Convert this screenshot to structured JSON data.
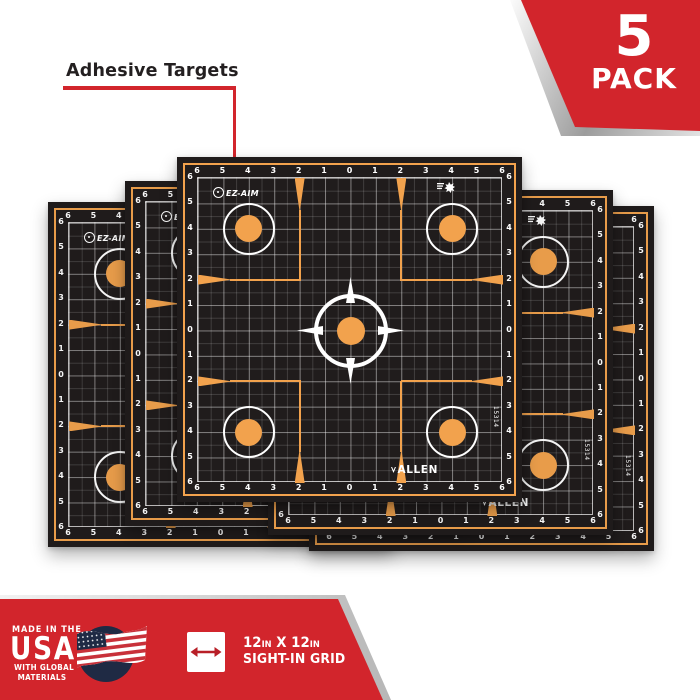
{
  "callout": {
    "label": "Adhesive Targets",
    "line_color": "#D2252C"
  },
  "pack_badge": {
    "count": "5",
    "word": "PACK",
    "red": "#D2252C"
  },
  "target": {
    "scale_numbers": [
      "6",
      "5",
      "4",
      "3",
      "2",
      "1",
      "0",
      "1",
      "2",
      "3",
      "4",
      "5",
      "6"
    ],
    "logo_text": "EZ-AIM",
    "brand_text": "ALLEN",
    "item_number": "15314",
    "sheet_count": 5,
    "colors": {
      "orange": "#F2A24D",
      "sheet_black": "#201C1C",
      "grid_line": "#FFFFFF"
    }
  },
  "footer": {
    "made_line1": "MADE IN THE",
    "made_line2": "USA",
    "made_line3": "WITH GLOBAL",
    "made_line4": "MATERIALS",
    "size_big1": "12",
    "size_sup1": "IN",
    "size_x": " X ",
    "size_big2": "12",
    "size_sup2": "IN",
    "size_line2": "SIGHT-IN GRID",
    "banner_red": "#D2252C",
    "flag_navy": "#1F2A44"
  }
}
